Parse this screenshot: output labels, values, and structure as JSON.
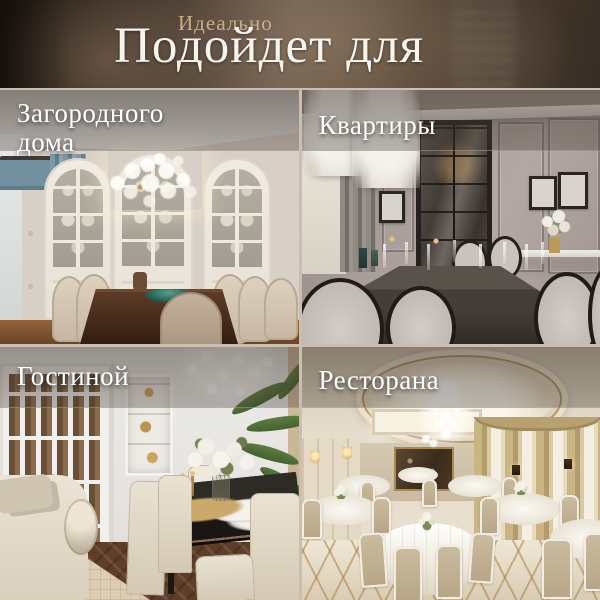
{
  "header": {
    "subtitle": "Идеально",
    "title": "Подойдет для"
  },
  "tiles": {
    "country_house": {
      "label": "Загородного\nдома",
      "alt": "Классическая столовая загородного дома: арочные витрины, люстра из стеклянных шаров, букет на столе"
    },
    "apartment": {
      "label": "Квартиры",
      "alt": "Столовая в квартире: серо-бежевые стены с молдингами, тёмный стол, стулья с овальными спинками"
    },
    "living_room": {
      "label": "Гостиной",
      "alt": "Светлая гостиная со столовой группой, белыми дверями, диваном и пальмой"
    },
    "restaurant": {
      "label": "Ресторана",
      "alt": "Банкетный зал ресторана: купольный потолок, хрустальные люстры, круглые столы с белыми скатертями"
    }
  },
  "colors": {
    "header_background": "#4a3c31",
    "subtitle_text": "#c8ad8a",
    "title_text": "#f7f4ee",
    "tile_label_text": "#ffffff",
    "divider": "#c9beb0",
    "label_overlay": "rgba(64,54,45,0.45)"
  }
}
